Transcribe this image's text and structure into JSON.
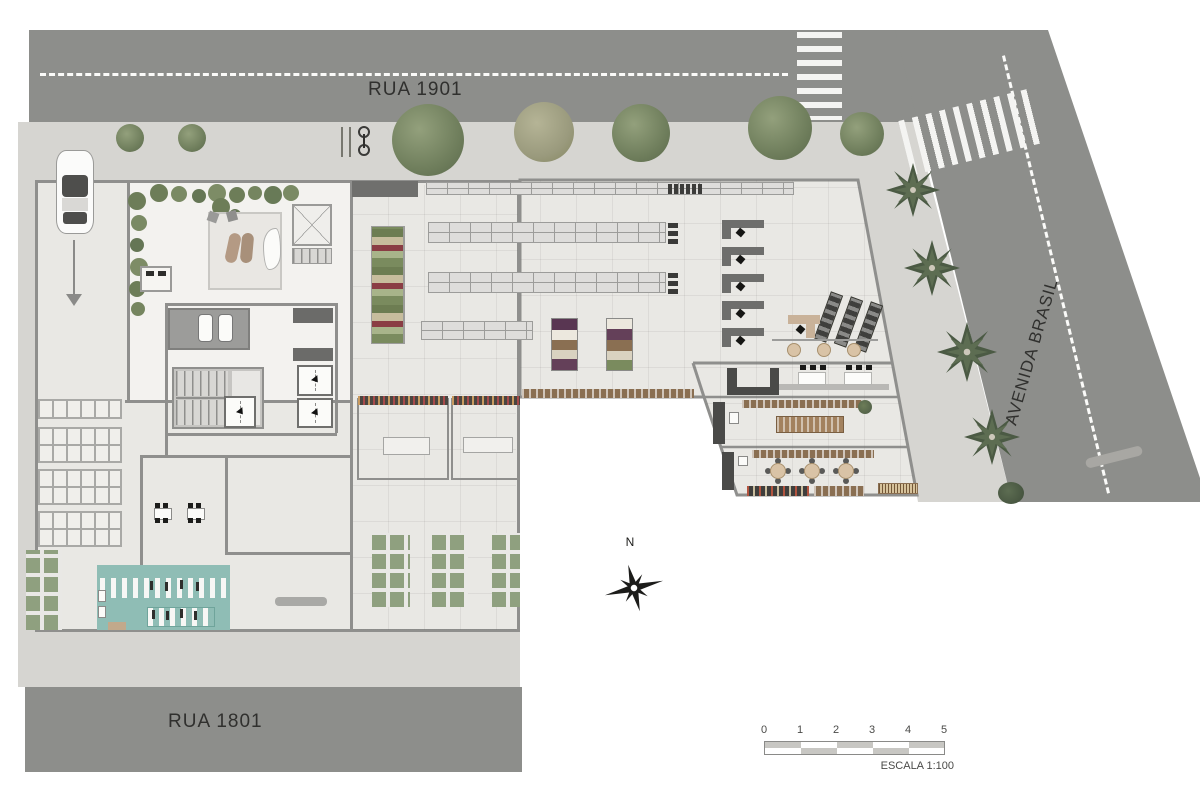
{
  "streets": {
    "top": "RUA 1901",
    "bottom": "RUA 1801",
    "right": "AVENIDA BRASIL"
  },
  "compass": {
    "north": "N"
  },
  "scale_bar": {
    "ticks": [
      "0",
      "1",
      "2",
      "3",
      "4",
      "5"
    ],
    "caption": "ESCALA 1:100"
  },
  "colors": {
    "background": "#ffffff",
    "road": "#8d8e8b",
    "road_marking": "#f7f7f5",
    "sidewalk": "#d6d5d1",
    "floor": "#e9e8e4",
    "floor_light": "#f3f2ef",
    "wall": "#8f8f8d",
    "counter_dark": "#6e6e6c",
    "teal_bike_room": "#8fbdb5",
    "wood": "#c9b299",
    "shelf_brown": "#8a6f52",
    "crate_green": "#8fa07f",
    "tree_green": "#6f7e5c",
    "palm_green": "#4b5a44",
    "text": "#30302e"
  }
}
